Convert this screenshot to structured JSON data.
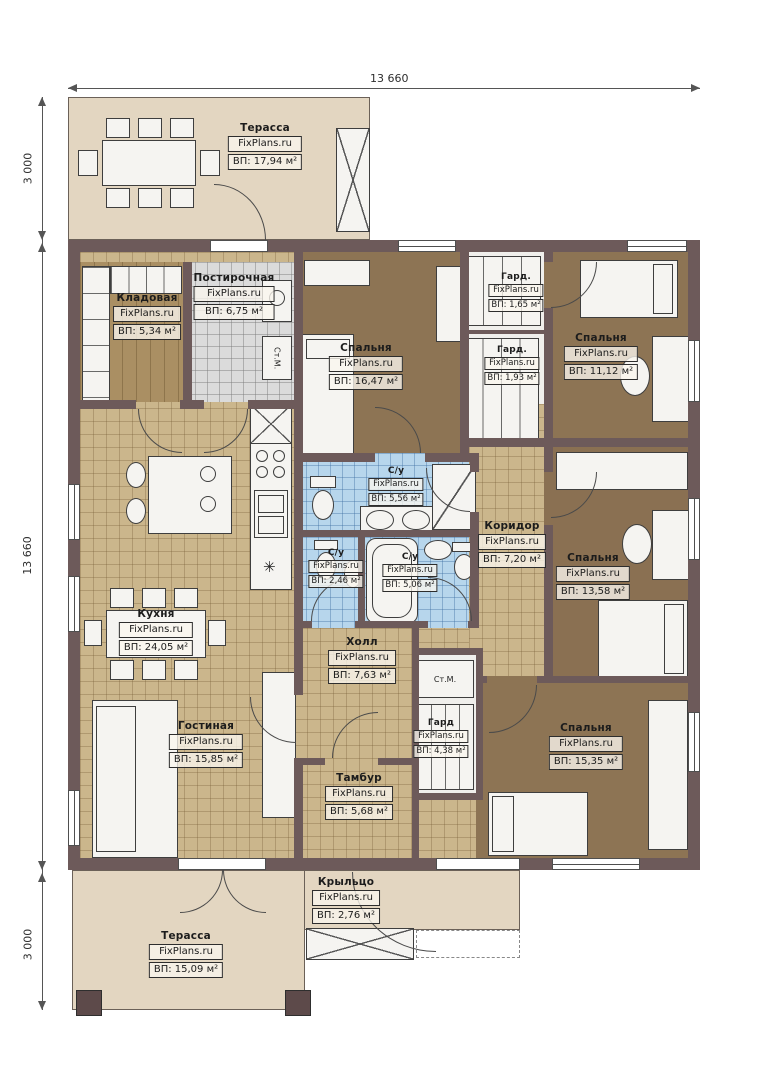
{
  "meta": {
    "watermark": "FixPlans.ru",
    "plan_type": "floor-plan"
  },
  "dimensions": {
    "top": "13 660",
    "left_top": "3 000",
    "left_middle": "13 660",
    "left_bottom": "3 000"
  },
  "rooms": {
    "terrace_top": {
      "name": "Терасса",
      "area": "ВП: 17,94 м²"
    },
    "pantry": {
      "name": "Кладовая",
      "area": "ВП: 5,34 м²"
    },
    "laundry": {
      "name": "Постирочная",
      "area": "ВП: 6,75 м²"
    },
    "bedroom1": {
      "name": "Спальня",
      "area": "ВП: 16,47 м²"
    },
    "wardrobe1": {
      "name": "Гард.",
      "area": "ВП: 1,65 м²"
    },
    "bedroom2": {
      "name": "Спальня",
      "area": "ВП: 11,12 м²"
    },
    "wardrobe2": {
      "name": "Гард.",
      "area": "ВП: 1,93 м²"
    },
    "kitchen": {
      "name": "Кухня",
      "area": "ВП: 24,05 м²"
    },
    "bath1": {
      "name": "С/у",
      "area": "ВП: 5,56 м²"
    },
    "bath2": {
      "name": "С/у",
      "area": "ВП: 2,46 м²"
    },
    "bath3": {
      "name": "С/у",
      "area": "ВП: 5,06 м²"
    },
    "corridor": {
      "name": "Коридор",
      "area": "ВП: 7,20 м²"
    },
    "bedroom3": {
      "name": "Спальня",
      "area": "ВП: 13,58 м²"
    },
    "living": {
      "name": "Гостиная",
      "area": "ВП: 15,85 м²"
    },
    "hall": {
      "name": "Холл",
      "area": "ВП: 7,63 м²"
    },
    "wardrobe3": {
      "name": "Гард",
      "area": "ВП: 4,38 м²"
    },
    "bedroom4": {
      "name": "Спальня",
      "area": "ВП: 15,35 м²"
    },
    "vestibule": {
      "name": "Тамбур",
      "area": "ВП: 5,68 м²"
    },
    "porch": {
      "name": "Крыльцо",
      "area": "ВП: 2,76 м²"
    },
    "terrace_bottom": {
      "name": "Терасса",
      "area": "ВП: 15,09 м²"
    }
  },
  "appliances": {
    "washer_label": "Ст.М.",
    "closet_washer_label": "Ст.М.",
    "fridge_symbol": "✳"
  },
  "colors": {
    "wall": "#6d5a5a",
    "terrace_floor": "#e3d6c1",
    "kitchen_floor": "#cbb68c",
    "bedroom_floor": "#8d7454",
    "bath_floor": "#b7d6ec",
    "laundry_floor": "#dbdbdb",
    "pantry_floor": "#aa8f63",
    "furniture": "#f5f4f1"
  }
}
